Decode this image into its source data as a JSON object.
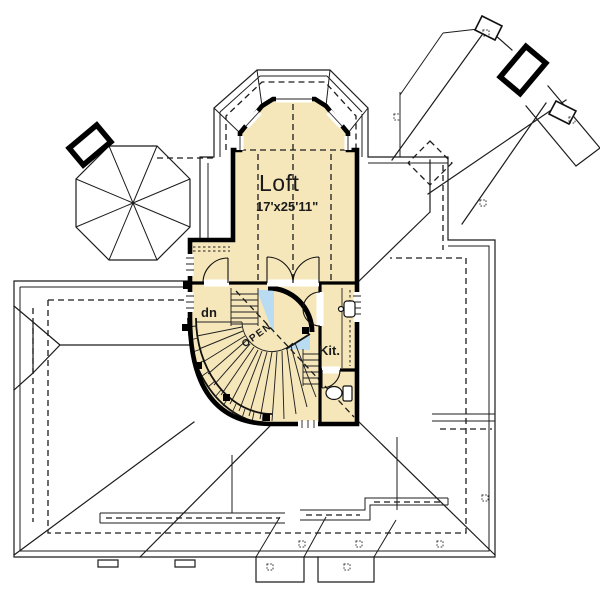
{
  "plan": {
    "title": "Second floor / loft plan with roof",
    "rooms": {
      "loft": {
        "name": "Loft",
        "dims": "17'x25'11\""
      },
      "kitchen": {
        "abbr": "Kit."
      },
      "stair": {
        "direction_label": "dn"
      },
      "open_to_below": {
        "label": "OPEN"
      }
    },
    "colors": {
      "floor": "#f6e7bb",
      "open_below": "#b9dcf2",
      "walls": "#000000",
      "roof_lines": "#1c1c1c",
      "background": "#ffffff"
    }
  }
}
